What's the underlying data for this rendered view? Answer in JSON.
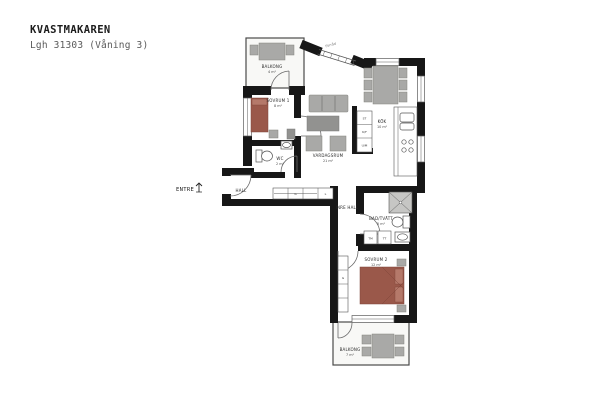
{
  "title": "KVASTMAKAREN",
  "subtitle": "Lgh 31303 (Våning 3)",
  "colors": {
    "wall": "#171717",
    "bed": "#9a584a",
    "bed_light": "#b5796a",
    "furniture": "#a9a9a7",
    "furniture_dark": "#929290",
    "balcony_floor": "#f8f8f6"
  },
  "labels": {
    "entre": "ENTRE",
    "forrad": "Förråd"
  },
  "rooms": [
    {
      "id": "balcony-top",
      "name": "BALKONG",
      "area": "4 m²"
    },
    {
      "id": "bedroom-1",
      "name": "SOVRUM 1",
      "area": "8 m²"
    },
    {
      "id": "wc",
      "name": "WC",
      "area": "2 m²"
    },
    {
      "id": "hall",
      "name": "HALL",
      "area": ""
    },
    {
      "id": "living-room",
      "name": "VARDAGSRUM",
      "area": "21 m²"
    },
    {
      "id": "kitchen",
      "name": "KÖK",
      "area": "10 m²"
    },
    {
      "id": "inner-hall",
      "name": "INRE HALL",
      "area": ""
    },
    {
      "id": "bathroom",
      "name": "BAD/TVÄTT",
      "area": "5 m²"
    },
    {
      "id": "bedroom-2",
      "name": "SOVRUM 2",
      "area": "12 m²"
    },
    {
      "id": "balcony-bottom",
      "name": "BALKONG",
      "area": "7 m²"
    }
  ],
  "units": {
    "st": "ST",
    "kf": "K/F",
    "um": "U/M",
    "tm": "TM",
    "tt": "TT",
    "g": "G",
    "l": "L"
  }
}
